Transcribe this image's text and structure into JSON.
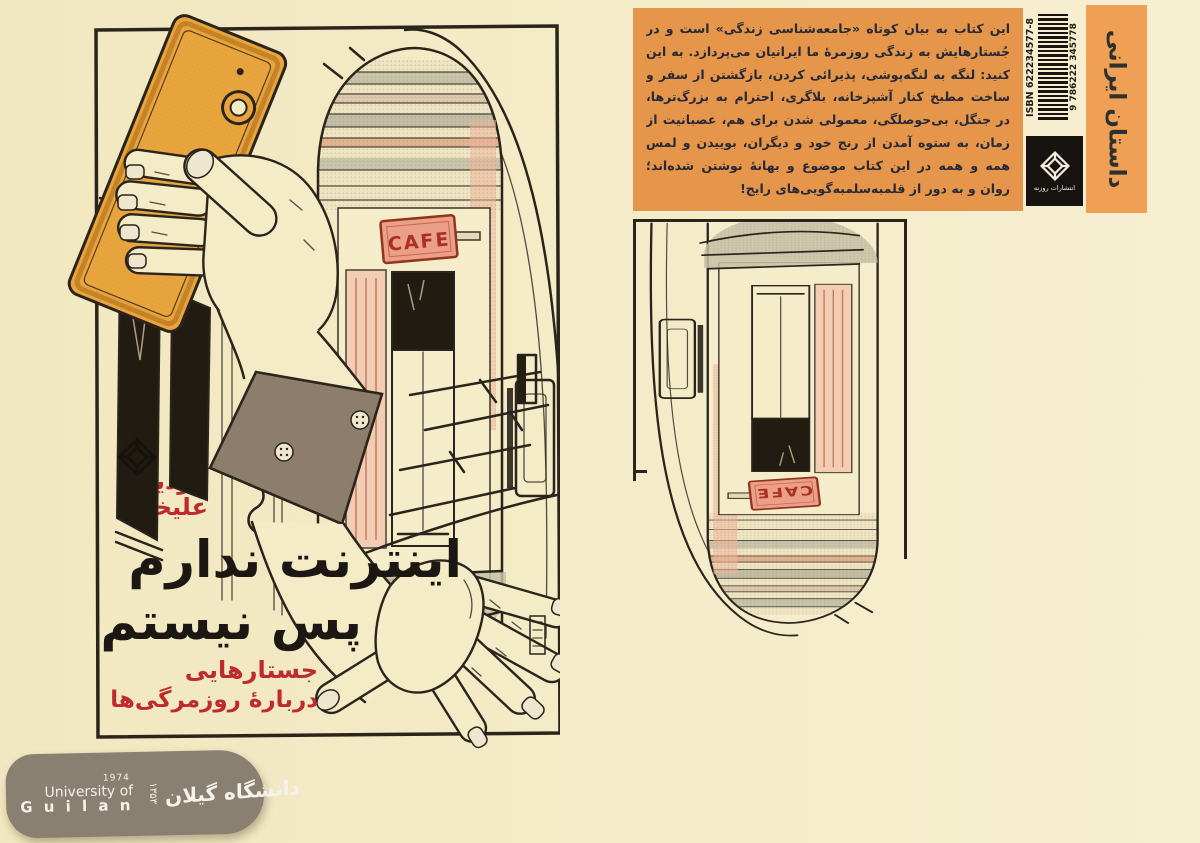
{
  "front_cover": {
    "author_line1": "فردین",
    "author_line2": "علیخواه",
    "title_line1": "اینترنت ندارم",
    "title_line2": "پس نیستم",
    "subtitle_line1": "جستارهایی",
    "subtitle_line2": "دربارۀ روزمرگی‌ها",
    "cafe_sign": "CAFE"
  },
  "back_cover": {
    "blurb_lines": [
      "این کتاب به بیان کوتاه «جامعه‌شناسی زندگی» است و در همهٔ",
      "جُستارهایش به زندگی روزمرهٔ ما ایرانیان می‌پردازد. به این کلمات دقت",
      "کنید: لنگه به لنگه‌پوشی، پذیرائی کردن، بازگشتن از سفر و فکر به طلاق،",
      "ساخت مطبخ کنار آشپزخانه، بلاگری، احترام به بزرگ‌ترها، میز غذا چیدن",
      "در جنگل، بی‌حوصلگی، معمولی شدن برای هم، عصبانیت از گذر سریع",
      "زمان، به ستوه آمدن از رنج خود و دیگران، بوییدن و لمس آجرهای کهنه!",
      "همه و همه در این کتاب موضوع و بهانهٔ نوشتن شده‌اند؛ نوشتاری با نثری",
      "روان و به دور از قلمبه‌سلمبه‌گویی‌های رایج!"
    ],
    "isbn_label": "ISBN 622234577-8",
    "barcode_number": "9 786222 345778",
    "publisher_name": "انتشارات روزنه",
    "genre_label": "داستان ایرانی"
  },
  "footer_badge": {
    "year_gregorian": "1974",
    "university_line1": "University of",
    "university_line2": "G u i l a n",
    "year_persian": "۱۳۵۳",
    "university_persian": "دانشگاه گیلان"
  },
  "colors": {
    "page_cream": "#f4ebc7",
    "blurb_orange": "#e6964b",
    "spine_orange": "#f0a055",
    "accent_red": "#bf2a2c",
    "phone_orange": "#e9a43c",
    "badge_gray": "#8a8071",
    "ink": "#2b241c"
  }
}
